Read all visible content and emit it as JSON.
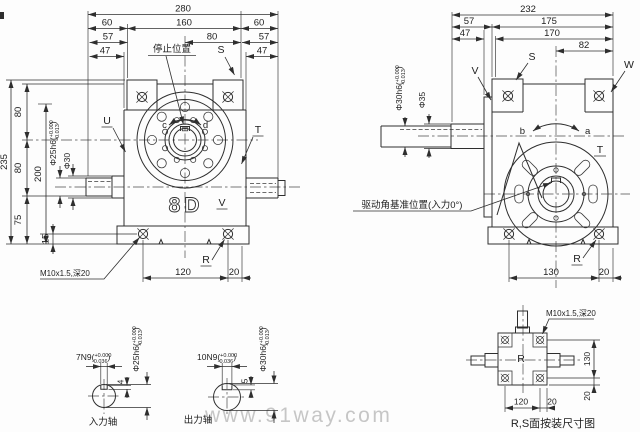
{
  "colors": {
    "line": "#2e2e2e",
    "background": "#ffffff",
    "watermark": "#c6c6c6"
  },
  "watermark": "www.91way.com",
  "front": {
    "dim280": "280",
    "dim60l": "60",
    "dim160": "160",
    "dim60r": "60",
    "dim57l": "57",
    "dim80c": "80",
    "dim57r": "57",
    "dim47l": "47",
    "dim47r": "47",
    "dim235": "235",
    "dim80a": "80",
    "dim80b": "80",
    "dim200": "200",
    "dim75": "75",
    "dim15": "15",
    "dim120": "120",
    "dim20": "20",
    "dia25_main": "Φ25h6(",
    "dia25_top": "+0.000",
    "dia25_bot": "-0.013",
    "dia25_close": ")",
    "dia30": "Φ30",
    "stop_label": "停止位置",
    "thread_note": "M10x1.5,深20",
    "logo": "8D",
    "lblS": "S",
    "lblU": "U",
    "lblT": "T",
    "lblV": "V",
    "lblR": "R",
    "lblC": "c",
    "lblD": "d"
  },
  "side": {
    "dim232": "232",
    "dim57": "57",
    "dim175": "175",
    "dim47": "47",
    "dim170": "170",
    "dim82": "82",
    "dim130": "130",
    "dim20": "20",
    "dia30_main": "Φ30h6(",
    "dia30_top": "+0.000",
    "dia30_bot": "-0.013",
    "dia30_close": ")",
    "dia35": "Φ35",
    "drive_note": "驱动角基准位置(入力0°)",
    "lblV": "V",
    "lblS": "S",
    "lblW": "W",
    "lblT": "T",
    "lblR": "R",
    "lblA": "a",
    "lblB": "b"
  },
  "input_shaft": {
    "caption": "入力轴",
    "key_main": "7N9(",
    "key_top": "+0.000",
    "key_bot": "-0.036",
    "key_close": ")",
    "depth": "4",
    "dia_main": "Φ25h6(",
    "dia_top": "+0.000",
    "dia_bot": "-0.013",
    "dia_close": ")"
  },
  "output_shaft": {
    "caption": "出力轴",
    "key_main": "10N9(",
    "key_top": "+0.000",
    "key_bot": "-0.036",
    "key_close": ")",
    "depth": "5",
    "dia_main": "Φ30h6(",
    "dia_top": "+0.000",
    "dia_bot": "-0.013",
    "dia_close": ")"
  },
  "mount": {
    "caption": "R,S面按装尺寸图",
    "face": "R",
    "thread_note": "M10x1.5,深20",
    "dim130": "130",
    "dim20v": "20",
    "dim120": "120",
    "dim20h": "20"
  }
}
